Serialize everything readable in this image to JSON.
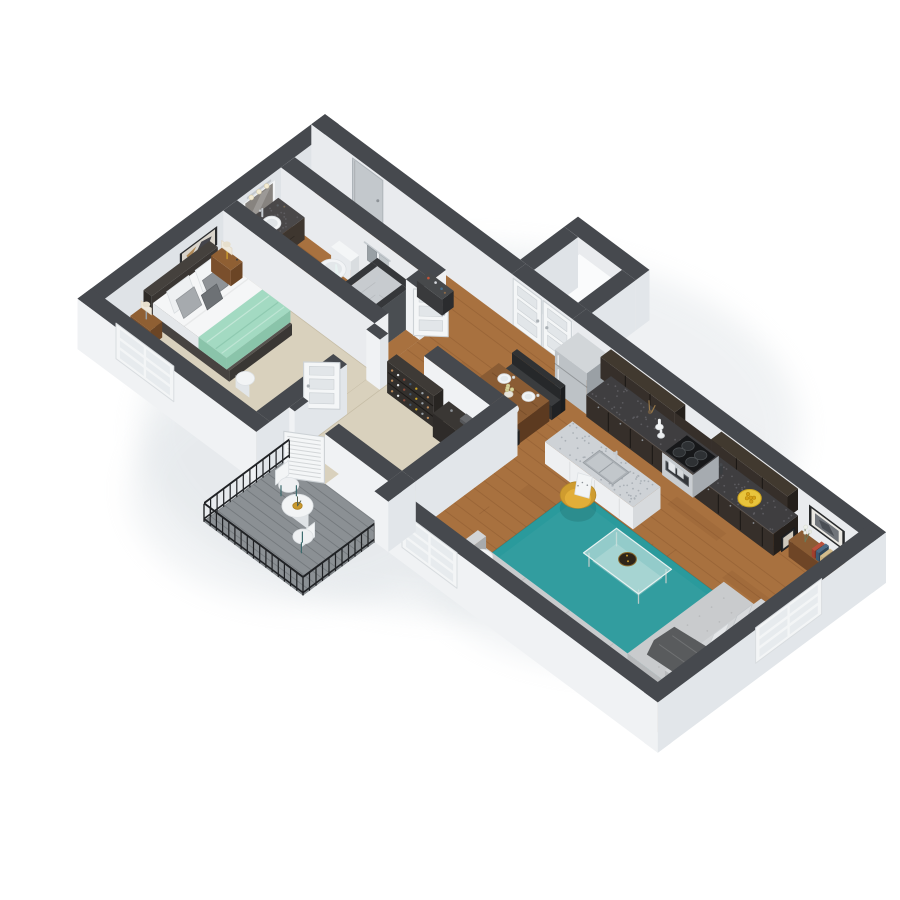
{
  "meta": {
    "type": "3d-floorplan-render",
    "description": "Isometric 3D floor plan of a one-bedroom apartment with balcony",
    "view": "isometric-top-down"
  },
  "palette": {
    "bg": "#ffffff",
    "wallTop": "#46494e",
    "wallS": "#f0f2f4",
    "wallE": "#e2e6ea",
    "wallInnerS": "#e9ebee",
    "wallInnerE": "#dfe3e7",
    "wood": "#a8713f",
    "woodLine": "rgba(80,45,18,0.16)",
    "woodPatch": "rgba(110,60,25,0.10)",
    "carpet": "#d9d1bd",
    "carpetEdge": "#c6bda6",
    "deck": "#8b9094",
    "deckLine": "#74797d",
    "rail": "#202225",
    "rug": "#2a9a9c",
    "espresso": "#362f2a",
    "espressoDark": "#241f1b",
    "espressoLine": "#1a1613",
    "graniteDark": "#3f3e40",
    "graniteSpeck": "#5c5b5f",
    "graniteLight": "#ced2d6",
    "graniteLightSpeck": "#aab0b6",
    "stainless": "#bdc2c6",
    "stainlessDark": "#9aa0a5",
    "white": "#f4f6f7",
    "whiteShade": "#e2e6e9",
    "whiteDark": "#d3d8db",
    "mint": "#a3dac2",
    "mintDark": "#8ac4aa",
    "gold": "#e2ae38",
    "goldDark": "#cf9c2f",
    "sofa": "#c9cbcd",
    "sofaShade": "#b7b9bb",
    "sofaDark": "#a8aaac",
    "pillowDark": "#4d4e50",
    "throwDark": "#595b5d",
    "walnut": "#8a5c34",
    "walnutDark": "#6e4526",
    "walnutDeep": "#5c3a20",
    "black": "#1f2123",
    "tile": "#c7cbcf",
    "tileDark": "#43464a",
    "tileFloor": "#b7bcc0",
    "glass": "rgba(196,226,223,0.55)",
    "glassEdge": "#e7f2f1",
    "glassTop": "rgba(198,228,225,0.66)",
    "frame": "#27292b",
    "photo": "#70747a",
    "doorGray": "#c3c8cc",
    "doorStroke": "#cdd2d6",
    "pane": "#e7ebee",
    "heater": "#f3f5f6",
    "chrome": "#c6cbd0",
    "lemon": "#e8c43c",
    "lemonDark": "#caa21f",
    "shadow": "#dde2e6"
  },
  "rooms": [
    {
      "id": "entry",
      "label": "Entry",
      "items": [
        "entry-door",
        "utility-closet",
        "double-doors",
        "water-heater",
        "shoe-shelf"
      ]
    },
    {
      "id": "bathroom",
      "label": "Bathroom",
      "items": [
        "vanity",
        "mirror",
        "vanity-lights",
        "toilet",
        "towel-bar",
        "shower",
        "bathroom-door"
      ]
    },
    {
      "id": "bedroom",
      "label": "Bedroom",
      "items": [
        "bed",
        "headboard",
        "mint-throw",
        "nightstand",
        "lamp",
        "wall-art",
        "window",
        "bedroom-door",
        "stool"
      ]
    },
    {
      "id": "closet",
      "label": "Walk-in Closet",
      "items": [
        "shoe-shelves",
        "dresser",
        "hanging-clothes",
        "louvered-door"
      ]
    },
    {
      "id": "kitchen",
      "label": "Kitchen",
      "items": [
        "refrigerator",
        "upper-cabinets",
        "microwave",
        "range",
        "counter",
        "island",
        "sink",
        "fruit-plate"
      ]
    },
    {
      "id": "dining",
      "label": "Dining",
      "items": [
        "dining-table",
        "bench",
        "place-settings",
        "centerpiece"
      ]
    },
    {
      "id": "living",
      "label": "Living Room",
      "items": [
        "area-rug",
        "sectional-sofa",
        "coffee-table",
        "accent-chair",
        "console-table",
        "wall-frame",
        "windows",
        "side-table"
      ]
    },
    {
      "id": "balcony",
      "label": "Balcony",
      "items": [
        "railing",
        "bistro-table",
        "patio-chairs",
        "deck"
      ]
    }
  ]
}
